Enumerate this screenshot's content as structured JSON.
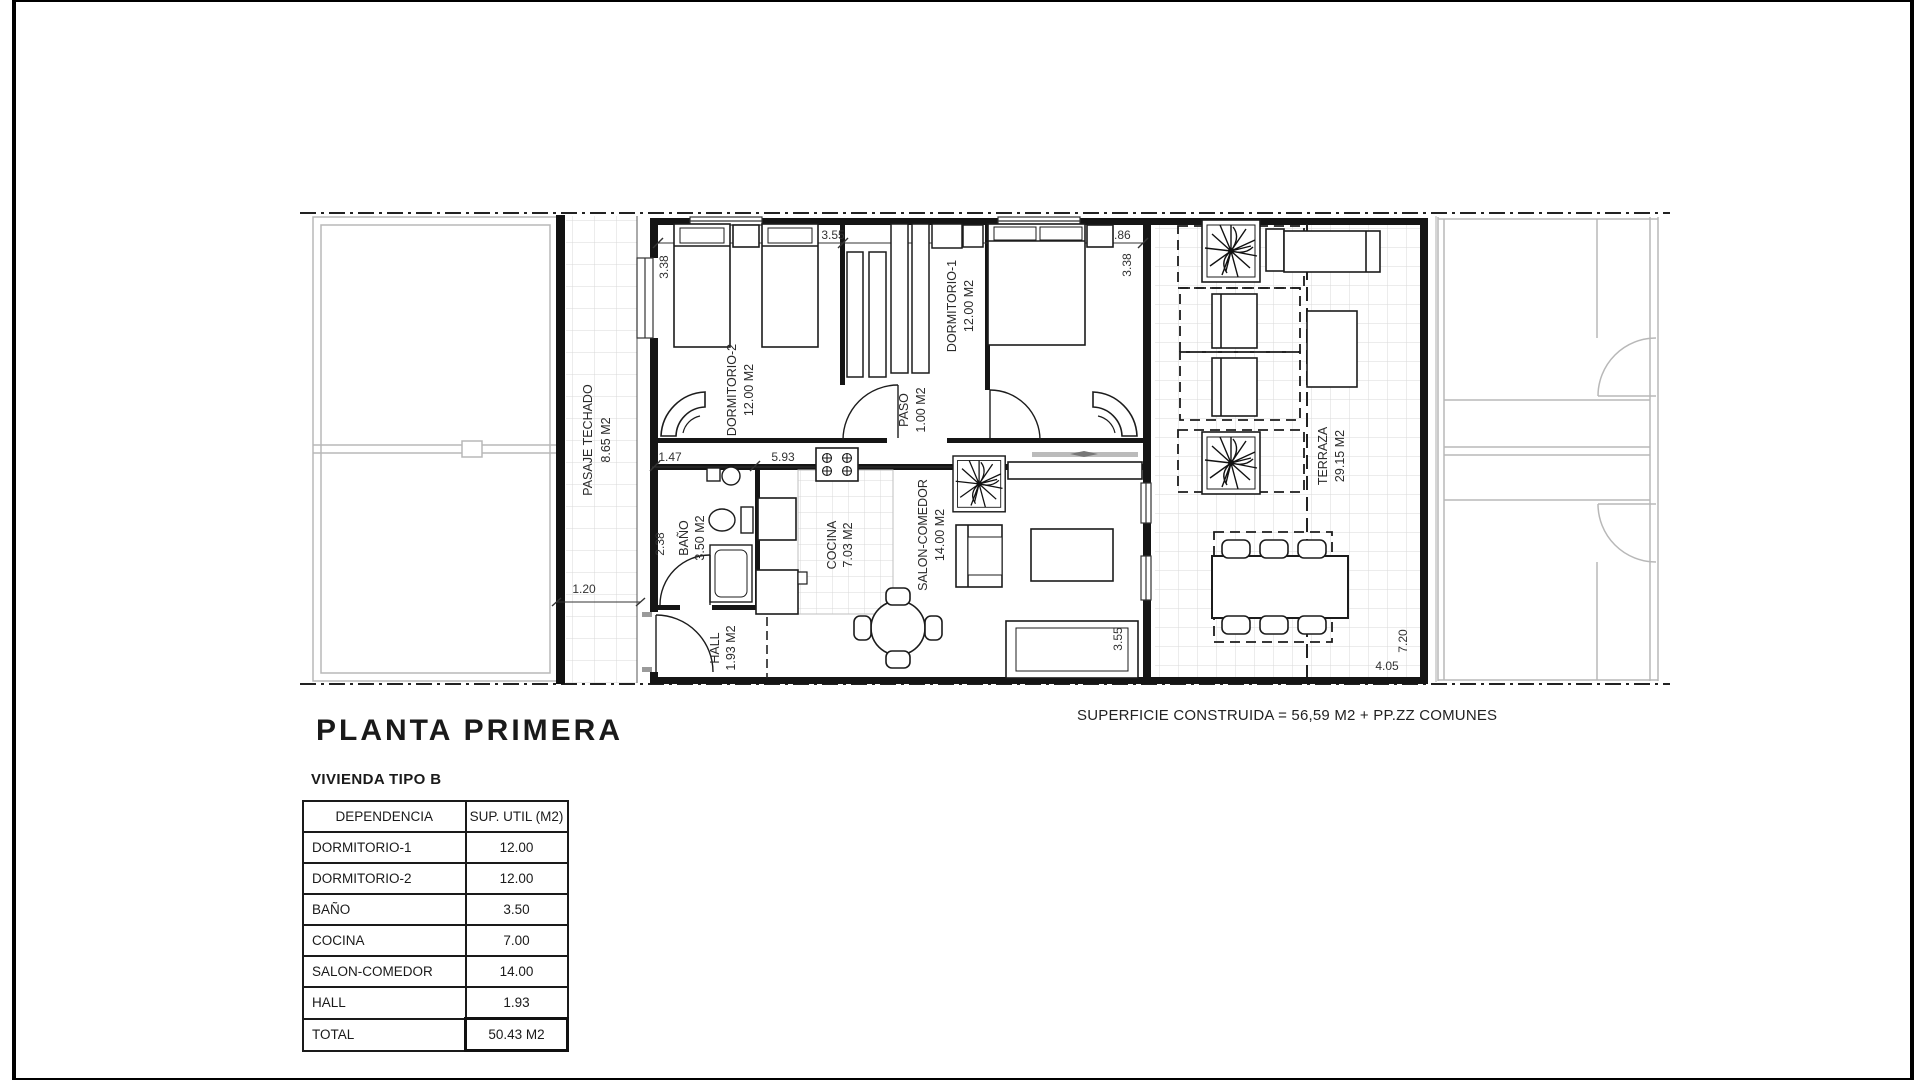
{
  "sheet": {
    "title": "PLANTA PRIMERA",
    "subtitle": "VIVIENDA TIPO B",
    "construida_note": "SUPERFICIE CONSTRUIDA = 56,59 M2 + PP.ZZ COMUNES"
  },
  "table": {
    "headers": [
      "DEPENDENCIA",
      "SUP. UTIL (M2)"
    ],
    "rows": [
      {
        "name": "DORMITORIO-1",
        "value": "12.00"
      },
      {
        "name": "DORMITORIO-2",
        "value": "12.00"
      },
      {
        "name": "BAÑO",
        "value": "3.50"
      },
      {
        "name": "COCINA",
        "value": "7.00"
      },
      {
        "name": "SALON-COMEDOR",
        "value": "14.00"
      },
      {
        "name": "HALL",
        "value": "1.93"
      },
      {
        "name": "TOTAL",
        "value": "50.43 M2"
      }
    ]
  },
  "plan": {
    "rooms": [
      {
        "name": "PASAJE TECHADO",
        "area": "8.65 M2"
      },
      {
        "name": "DORMITORIO-2",
        "area": "12.00 M2"
      },
      {
        "name": "DORMITORIO-1",
        "area": "12.00 M2"
      },
      {
        "name": "PASO",
        "area": "1.00 M2"
      },
      {
        "name": "BAÑO",
        "area": "3.50 M2"
      },
      {
        "name": "COCINA",
        "area": "7.03 M2"
      },
      {
        "name": "SALON-COMEDOR",
        "area": "14.00 M2"
      },
      {
        "name": "HALL",
        "area": "1.93 M2"
      },
      {
        "name": "TERRAZA",
        "area": "29.15 M2"
      }
    ],
    "dims": {
      "dorm2_w": "3.55",
      "dorm1_w": "3.86",
      "dorm2_h": "3.38",
      "dorm1_h": "3.38",
      "bath_w": "1.47",
      "kitchen_w": "5.93",
      "bath_h": "2.38",
      "pasaje_w": "1.20",
      "salon_h": "3.55",
      "terraza_w": "4.05",
      "terraza_h": "7.20"
    }
  },
  "colors": {
    "ink": "#1c1c1c",
    "faint_unit": "#b8b8b8",
    "tile_grid": "#d9d9d9"
  }
}
